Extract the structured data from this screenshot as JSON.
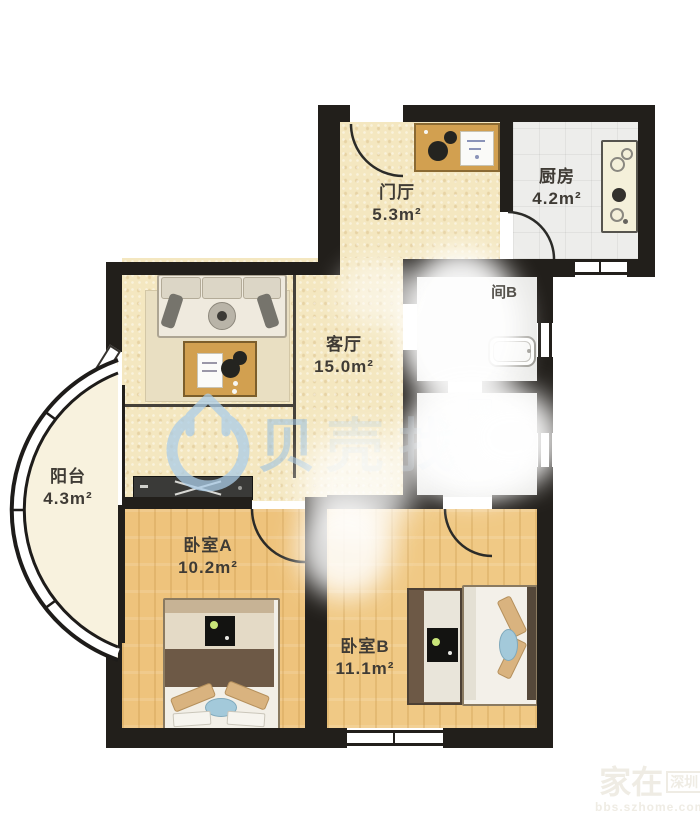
{
  "floorplan": {
    "rooms": [
      {
        "id": "hall",
        "name": "门厅",
        "area": "5.3m²"
      },
      {
        "id": "kitchen",
        "name": "厨房",
        "area": "4.2m²"
      },
      {
        "id": "living",
        "name": "客厅",
        "area": "15.0m²"
      },
      {
        "id": "balcony",
        "name": "阳台",
        "area": "4.3m²"
      },
      {
        "id": "bedroom-a",
        "name": "卧室A",
        "area": "10.2m²"
      },
      {
        "id": "bedroom-b",
        "name": "卧室B",
        "area": "11.1m²"
      },
      {
        "id": "bathroom-b",
        "name": "间B",
        "area": ""
      }
    ],
    "watermarks": {
      "brand_first": "贝",
      "brand_rest": "壳找房",
      "corner_line1": "家在",
      "corner_boxed": "深圳",
      "corner_line2": "bbs.szhome.com"
    },
    "colors": {
      "wall": "#221f1b",
      "floor_warm": "#f4e7c0",
      "floor_wood": "#eec37c",
      "floor_tile": "#ededeb",
      "floor_grey": "#e9e9e7",
      "watermark_blue": "#9fc3e0",
      "label_text": "#3f3b35"
    }
  }
}
